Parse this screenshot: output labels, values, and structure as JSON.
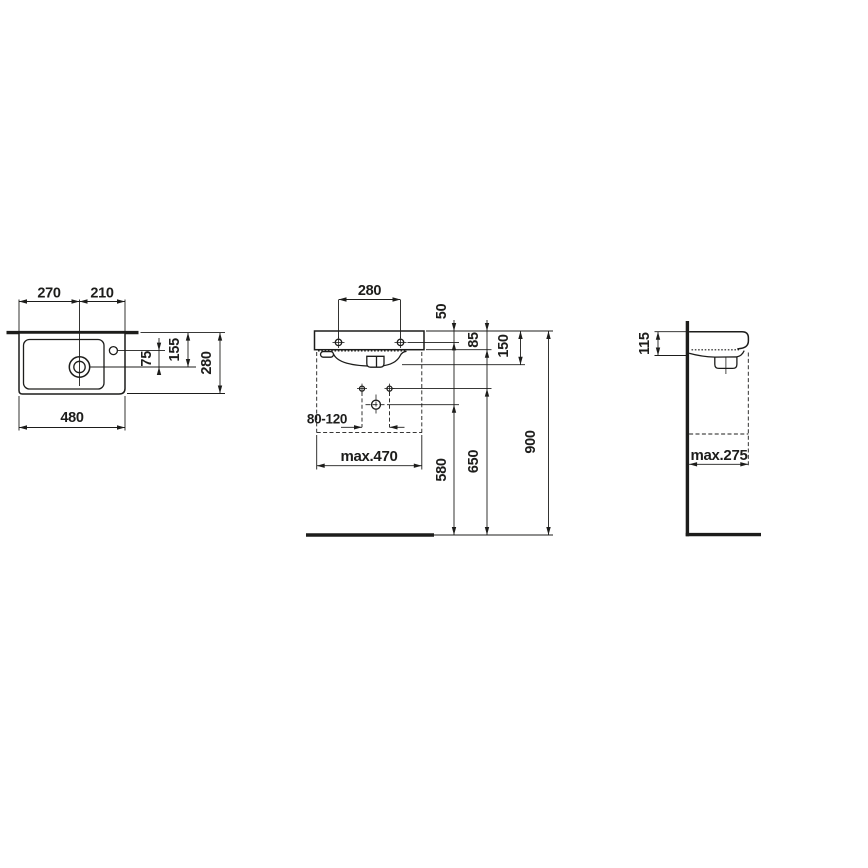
{
  "meta": {
    "description": "Technical dimension drawing of a wall-mounted washbasin in three orthographic views (top, front, side)",
    "background_color": "#ffffff",
    "line_color": "#1d1d1b"
  },
  "top_view": {
    "labels": {
      "left_offset": "270",
      "right_offset": "210",
      "overall_width": "480",
      "tap_to_drain": "75",
      "wall_to_drain": "155",
      "overall_depth": "280"
    }
  },
  "front_view": {
    "labels": {
      "hole_spacing": "280",
      "rim_to_holes": "50",
      "rim_to_apron": "85",
      "front_height": "150",
      "supply_spacing": "80-120",
      "max_width": "max.470",
      "drain_height": "580",
      "supply_height": "650",
      "rim_height": "900"
    }
  },
  "side_view": {
    "labels": {
      "profile_height": "115",
      "max_depth": "max.275"
    }
  }
}
